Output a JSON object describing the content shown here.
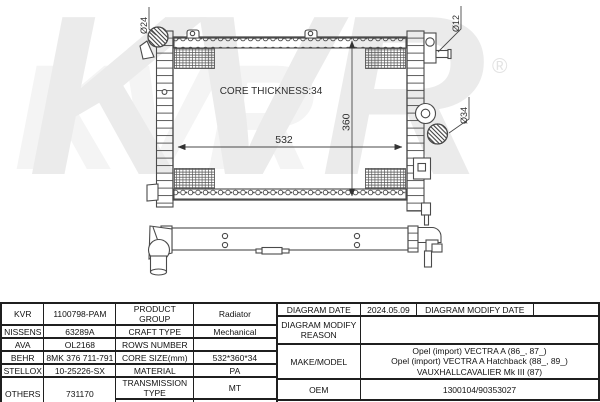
{
  "diagram": {
    "front_view_labels": {
      "core_thickness": "CORE THICKNESS:34",
      "core_width": "532",
      "core_height": "360",
      "inlet_diameter": "Ø24",
      "top_right_diameter": "Ø12",
      "outlet_diameter": "Ø34"
    },
    "watermark": {
      "brand": "KVR",
      "registered": "®"
    }
  },
  "table": {
    "brands": [
      {
        "name": "KVR",
        "code": "1100798-PAM"
      },
      {
        "name": "NISSENS",
        "code": "63289A"
      },
      {
        "name": "AVA",
        "code": "OL2168"
      },
      {
        "name": "BEHR",
        "code": "8MK 376 711-791"
      },
      {
        "name": "STELLOX",
        "code": "10-25226-SX"
      },
      {
        "name": "OTHERS",
        "code": "731170"
      }
    ],
    "specs": {
      "product_group_label": "PRODUCT GROUP",
      "product_group": "Radiator",
      "craft_type_label": "CRAFT TYPE",
      "craft_type": "Mechanical",
      "rows_number_label": "ROWS NUMBER",
      "rows_number": "",
      "core_size_label": "CORE SIZE(mm)",
      "core_size": "532*360*34",
      "material_label": "MATERIAL",
      "material": "PA",
      "transmission_label": "TRANSMISSION TYPE",
      "transmission": "MT",
      "supplementary_label": "SUPPLEMENTARY",
      "supplementary": ""
    },
    "right": {
      "diagram_date_label": "DIAGRAM DATE",
      "diagram_date": "2024.05.09",
      "diagram_modify_date_label": "DIAGRAM MODIFY DATE",
      "diagram_modify_date": "",
      "modify_reason_label": "DIAGRAM MODIFY REASON",
      "modify_reason": "",
      "make_model_label": "MAKE/MODEL",
      "make_model_lines": [
        "Opel (import) VECTRA A (86_, 87_)",
        "Opel (import) VECTRA A Hatchback (88_, 89_)",
        "VAUXHALLCAVALIER Mk III (87)"
      ],
      "oem_label": "OEM",
      "oem": "1300104/90353027"
    }
  }
}
